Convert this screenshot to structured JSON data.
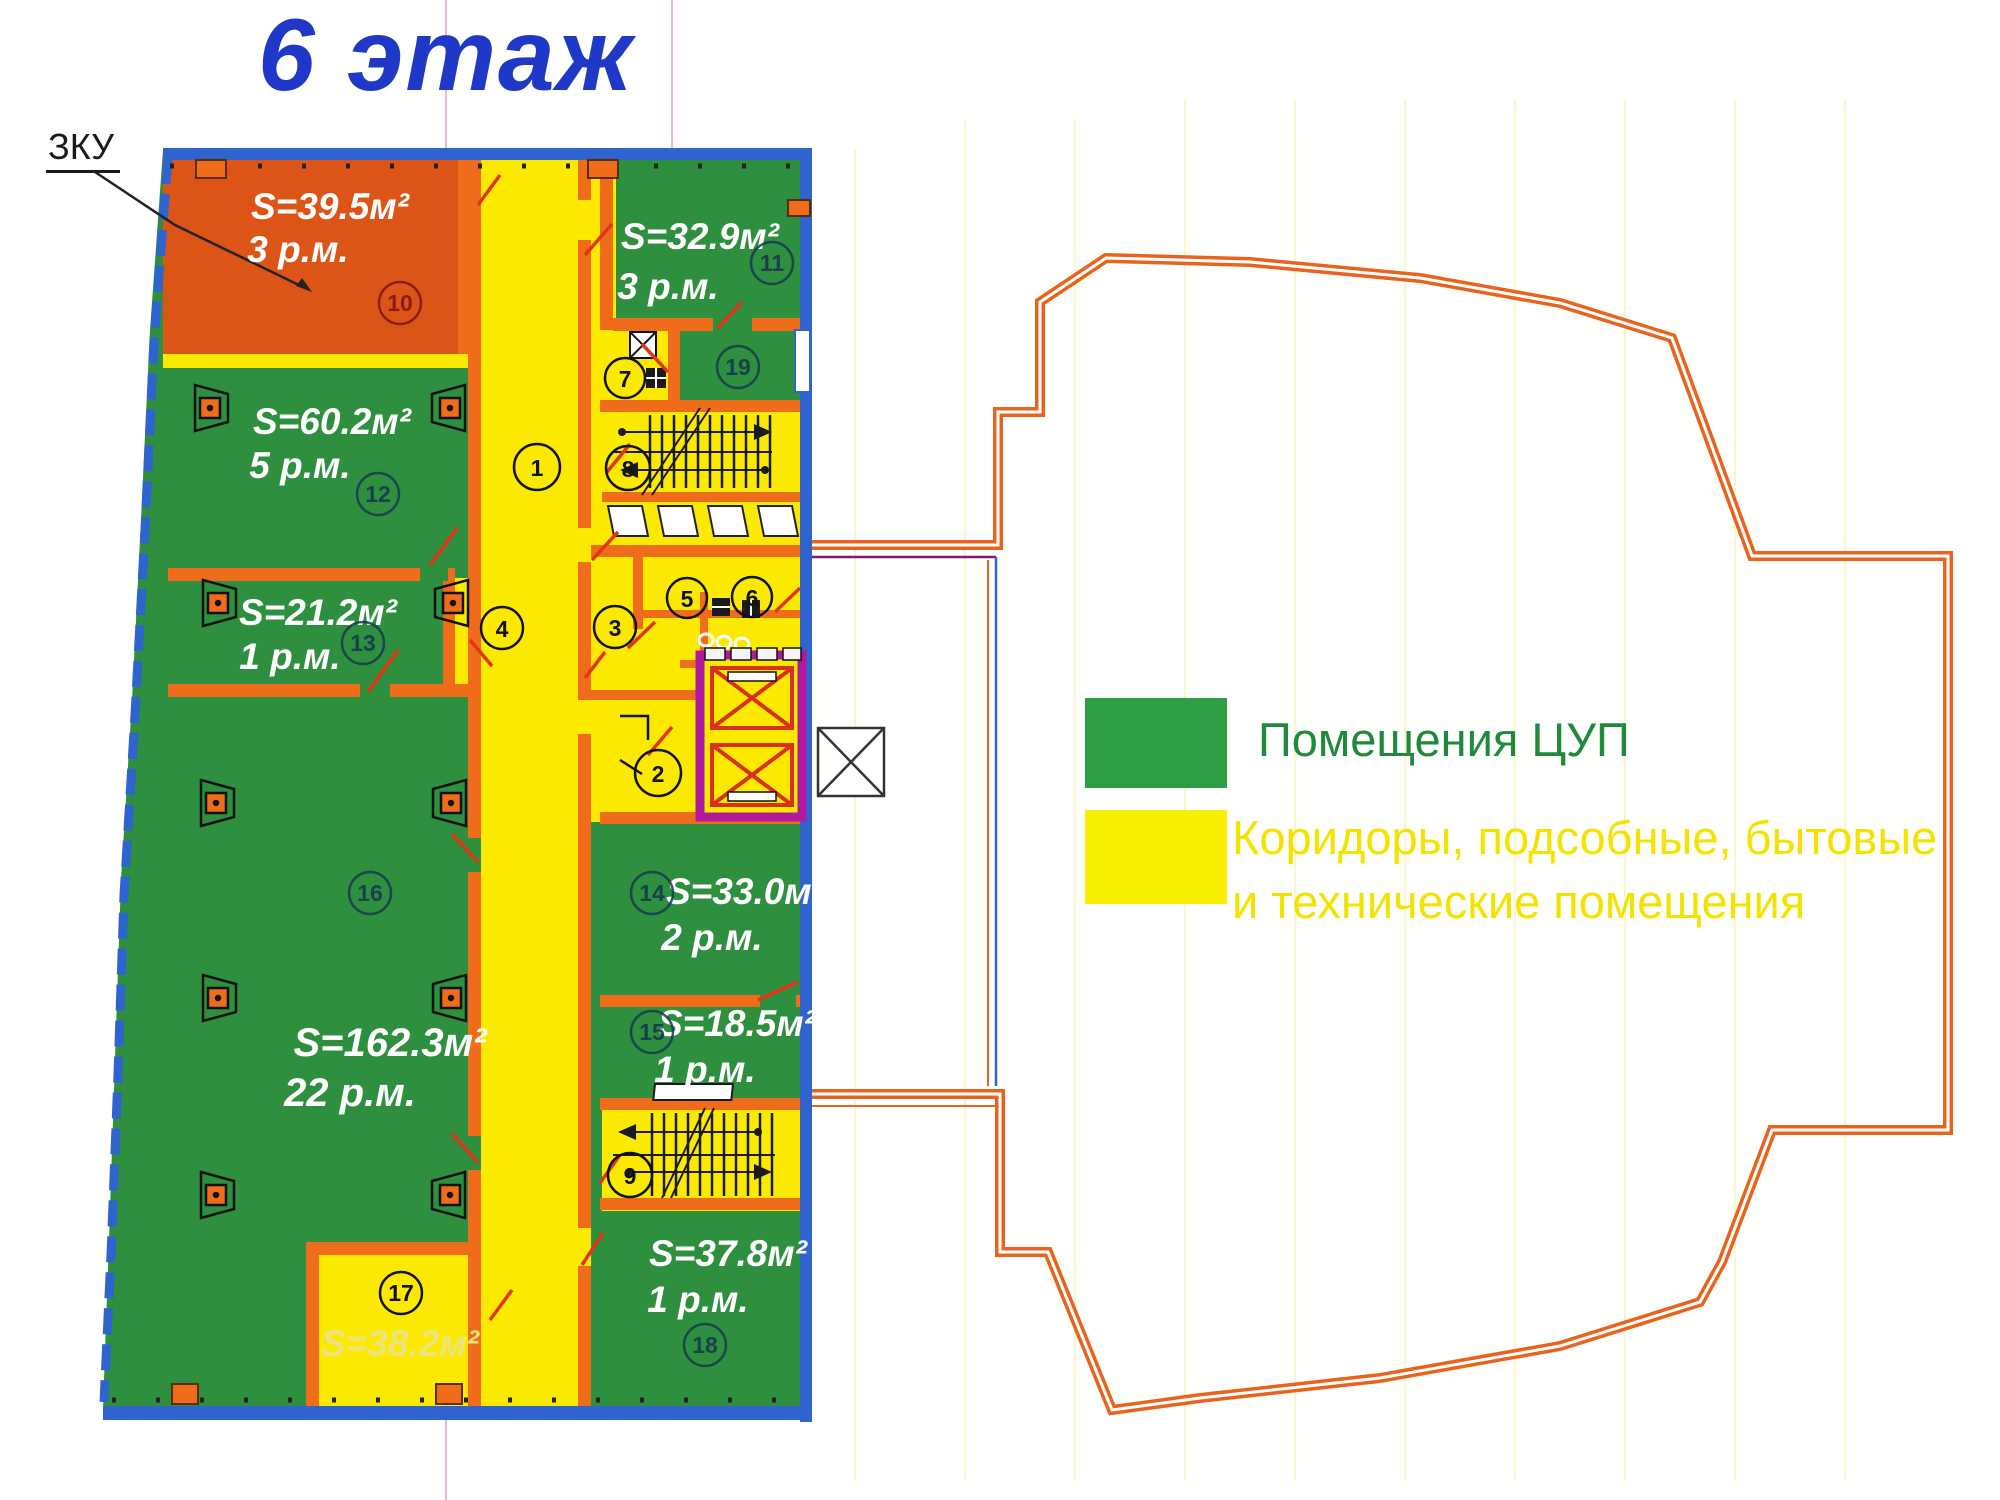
{
  "title": "6 этаж",
  "annotation": {
    "zku_label": "ЗКУ"
  },
  "legend": {
    "item1": {
      "label": "Помещения ЦУП"
    },
    "item2": {
      "line1": "Коридоры, подсобные, бытовые",
      "line2": "и технические помещения"
    }
  },
  "rooms": {
    "r10": {
      "num": "10",
      "area": "S=39.5м²",
      "places": "3 р.м."
    },
    "r11": {
      "num": "11",
      "area": "S=32.9м²",
      "places": "3 р.м."
    },
    "r12": {
      "num": "12",
      "area": "S=60.2м²",
      "places": "5 р.м."
    },
    "r13": {
      "num": "13",
      "area": "S=21.2м²",
      "places": "1 р.м."
    },
    "r14": {
      "num": "14",
      "area": "S=33.0м²",
      "places": "2 р.м."
    },
    "r15": {
      "num": "15",
      "area": "S=18.5м²",
      "places": "1 р.м."
    },
    "r16": {
      "num": "16",
      "area": "S=162.3м²",
      "places": "22 р.м."
    },
    "r17": {
      "num": "17",
      "area": "S=38.2м²"
    },
    "r18": {
      "num": "18",
      "area": "S=37.8м²",
      "places": "1 р.м."
    },
    "r19": {
      "num": "19"
    }
  },
  "zones": {
    "z1": "1",
    "z2": "2",
    "z3": "3",
    "z4": "4",
    "z5": "5",
    "z6": "6",
    "z7": "7",
    "z8": "8",
    "z9": "9"
  },
  "colors": {
    "cup_green": "#2E8F3E",
    "service_yellow": "#FBEA00",
    "zku_orange": "#DD5417",
    "wall_orange": "#EE6C1A",
    "outline_orange": "#E8641E",
    "border_blue": "#2F63CE",
    "elevator_magenta": "#B0189E",
    "title_blue": "#2038C8",
    "legend_green_text": "#1F8A3C",
    "legend_yellow_text": "#F4E300"
  }
}
